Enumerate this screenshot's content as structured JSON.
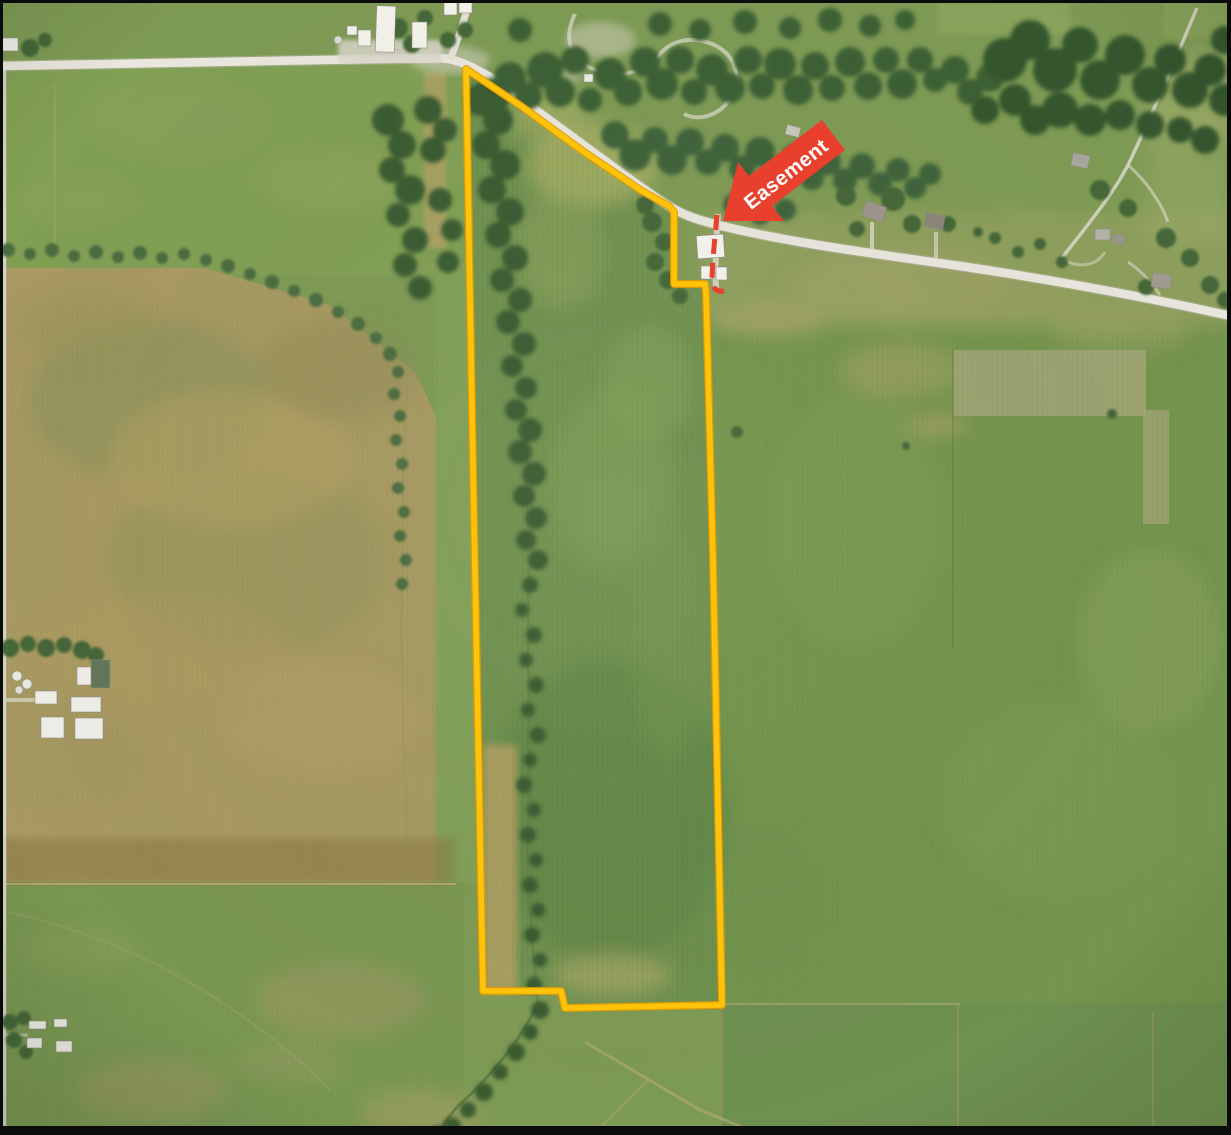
{
  "map": {
    "kind": "aerial-parcel-map",
    "annotations": {
      "easement": {
        "label": "Easement",
        "label_color": "#ffffff",
        "arrow_color": "#e8402d",
        "dash_color": "#e8402d"
      },
      "parcel_boundary": {
        "color": "#ffc30a",
        "outline_color": "#e49a00"
      }
    }
  }
}
